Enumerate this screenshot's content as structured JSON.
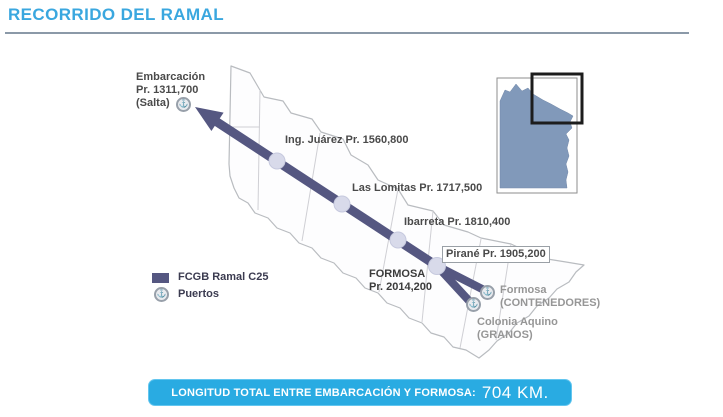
{
  "header": {
    "title": "RECORRIDO DEL RAMAL"
  },
  "route": {
    "origin": {
      "name": "Embarcación",
      "pr": "Pr. 1311,700",
      "province": "(Salta)"
    },
    "stations": [
      {
        "label": "Ing. Juárez Pr. 1560,800"
      },
      {
        "label": "Las Lomitas Pr. 1717,500"
      },
      {
        "label": "Ibarreta Pr. 1810,400"
      },
      {
        "label": "Pirané Pr. 1905,200"
      }
    ],
    "terminus": {
      "name": "FORMOSA",
      "pr": "Pr. 2014,200"
    },
    "ports": [
      {
        "name": "Formosa",
        "type": "(CONTENEDORES)"
      },
      {
        "name": "Colonia Aquino",
        "type": "(GRANOS)"
      }
    ]
  },
  "legend": {
    "line": "FCGB Ramal C25",
    "ports": "Puertos"
  },
  "banner": {
    "label": "LONGITUD TOTAL ENTRE EMBARCACIÓN Y FORMOSA:",
    "value": "704 KM."
  },
  "icons": {
    "port_glyph": "⚓"
  },
  "colors": {
    "accent_blue": "#29ABE2",
    "title_blue": "#3AA7DF",
    "route_purple": "#555781",
    "station_dot": "#D8DAEA",
    "inset_land": "#8199BA",
    "label_dark": "#4A4A4A",
    "label_gray": "#969696"
  }
}
